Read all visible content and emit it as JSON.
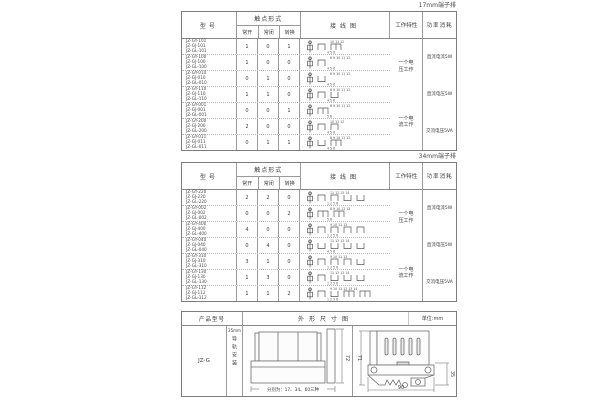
{
  "labels": {
    "table1_corner": "17mm端子排",
    "table2_corner": "34mm端子排"
  },
  "spec_header": {
    "model": "型号",
    "contact_form": "触点形式",
    "no": "常开",
    "nc": "常闭",
    "co": "转换",
    "wiring": "接线图",
    "characteristic": "工作特性",
    "power": "功率消耗"
  },
  "table1": {
    "rows": [
      {
        "models": [
          "JZ-GY-101",
          "JZ-GJ-101",
          "JZ-GL-101"
        ],
        "no": "1",
        "nc": "0",
        "co": "1",
        "contacts": [
          "no",
          "co"
        ],
        "top_nums": "10 11 12",
        "bot_nums": "4 5 6"
      },
      {
        "models": [
          "JZ-GY-100",
          "JZ-GJ-100",
          "JZ-GL-100"
        ],
        "no": "1",
        "nc": "0",
        "co": "0",
        "contacts": [
          "no"
        ],
        "top_nums": "8 9 10 11 12",
        "bot_nums": "4 5 6"
      },
      {
        "models": [
          "JZ-GY-010",
          "JZ-GJ-010",
          "JZ-GL-010"
        ],
        "no": "0",
        "nc": "1",
        "co": "0",
        "contacts": [
          "nc"
        ],
        "top_nums": "8 9 10 11 12",
        "bot_nums": "4 5 6"
      },
      {
        "models": [
          "JZ-GY-110",
          "JZ-GJ-110",
          "JZ-GL-110"
        ],
        "no": "1",
        "nc": "1",
        "co": "0",
        "contacts": [
          "no",
          "nc"
        ],
        "top_nums": "8 9 10 11 12",
        "bot_nums": "4 5 6"
      },
      {
        "models": [
          "JZ-GY-001",
          "JZ-GJ-001",
          "JZ-GL-001"
        ],
        "no": "0",
        "nc": "0",
        "co": "1",
        "contacts": [
          "co"
        ],
        "top_nums": "8 9 10 11 12",
        "bot_nums": "5 6"
      },
      {
        "models": [
          "JZ-GY-200",
          "JZ-GJ-200",
          "JZ-GL-200"
        ],
        "no": "2",
        "nc": "0",
        "co": "0",
        "contacts": [
          "no",
          "no"
        ],
        "top_nums": "10 11 12",
        "bot_nums": "4 5 6"
      },
      {
        "models": [
          "JZ-GY-011",
          "JZ-GJ-011",
          "JZ-GL-011"
        ],
        "no": "0",
        "nc": "1",
        "co": "1",
        "contacts": [
          "nc",
          "co"
        ],
        "top_nums": "8 9 10 11 12",
        "bot_nums": "4 5 6"
      }
    ],
    "characteristics": [
      "一个电压工作",
      "一个电流工作"
    ],
    "power": [
      "直流电流5W",
      "直流电压5W",
      "交流电压5VA"
    ]
  },
  "table2": {
    "rows": [
      {
        "models": [
          "JZ-GY-220",
          "JZ-GJ-220",
          "JZ-GL-220"
        ],
        "no": "2",
        "nc": "2",
        "co": "0",
        "contacts": [
          "no",
          "no",
          "nc",
          "nc"
        ],
        "top_nums": "11 12 13 14",
        "bot_nums": "1 2 5 6"
      },
      {
        "models": [
          "JZ-GY-002",
          "JZ-GJ-002",
          "JZ-GL-002"
        ],
        "no": "0",
        "nc": "0",
        "co": "2",
        "contacts": [
          "co",
          "co"
        ],
        "top_nums": "8 9 10 11 12",
        "bot_nums": "5 6"
      },
      {
        "models": [
          "JZ-GY-400",
          "JZ-GJ-400",
          "JZ-GL-400"
        ],
        "no": "4",
        "nc": "0",
        "co": "0",
        "contacts": [
          "no",
          "no",
          "no",
          "no"
        ],
        "top_nums": "9 10 11 12",
        "bot_nums": "1 2 5 6"
      },
      {
        "models": [
          "JZ-GY-040",
          "JZ-GJ-040",
          "JZ-GL-040"
        ],
        "no": "0",
        "nc": "4",
        "co": "0",
        "contacts": [
          "nc",
          "nc",
          "nc",
          "nc"
        ],
        "top_nums": "11 12 13 14",
        "bot_nums": "4 5 6"
      },
      {
        "models": [
          "JZ-GY-310",
          "JZ-GJ-310",
          "JZ-GL-310"
        ],
        "no": "3",
        "nc": "1",
        "co": "0",
        "contacts": [
          "no",
          "no",
          "no",
          "nc"
        ],
        "top_nums": "9 10 11 12",
        "bot_nums": "1 2 5 6"
      },
      {
        "models": [
          "JZ-GY-130",
          "JZ-GJ-130",
          "JZ-GL-130"
        ],
        "no": "1",
        "nc": "3",
        "co": "0",
        "contacts": [
          "no",
          "nc",
          "nc",
          "nc"
        ],
        "top_nums": "11 12 13 14",
        "bot_nums": "1 2 5 6"
      },
      {
        "models": [
          "JZ-GY-112",
          "JZ-GJ-112",
          "JZ-GL-112"
        ],
        "no": "1",
        "nc": "1",
        "co": "2",
        "contacts": [
          "no",
          "nc",
          "co",
          "co"
        ],
        "top_nums": "9 10 11 12 13 14",
        "bot_nums": "1 2 5 6"
      }
    ],
    "characteristics": [
      "一个电压工作",
      "一个电流工作"
    ],
    "power": [
      "直流电流5W",
      "直流电压5W",
      "交流电压5VA"
    ]
  },
  "bottom": {
    "header": {
      "product_model": "产品型号",
      "outline": "外形尺寸图",
      "unit": "单位:mm"
    },
    "model": "JZ-G",
    "mount_top": "35mm",
    "mount_vertical": "导轨安装",
    "front_note": "分别为：17、34、60三种",
    "dims": {
      "front_height": "72",
      "side_height": "71",
      "side_width": "90",
      "rail_width": "35"
    }
  }
}
